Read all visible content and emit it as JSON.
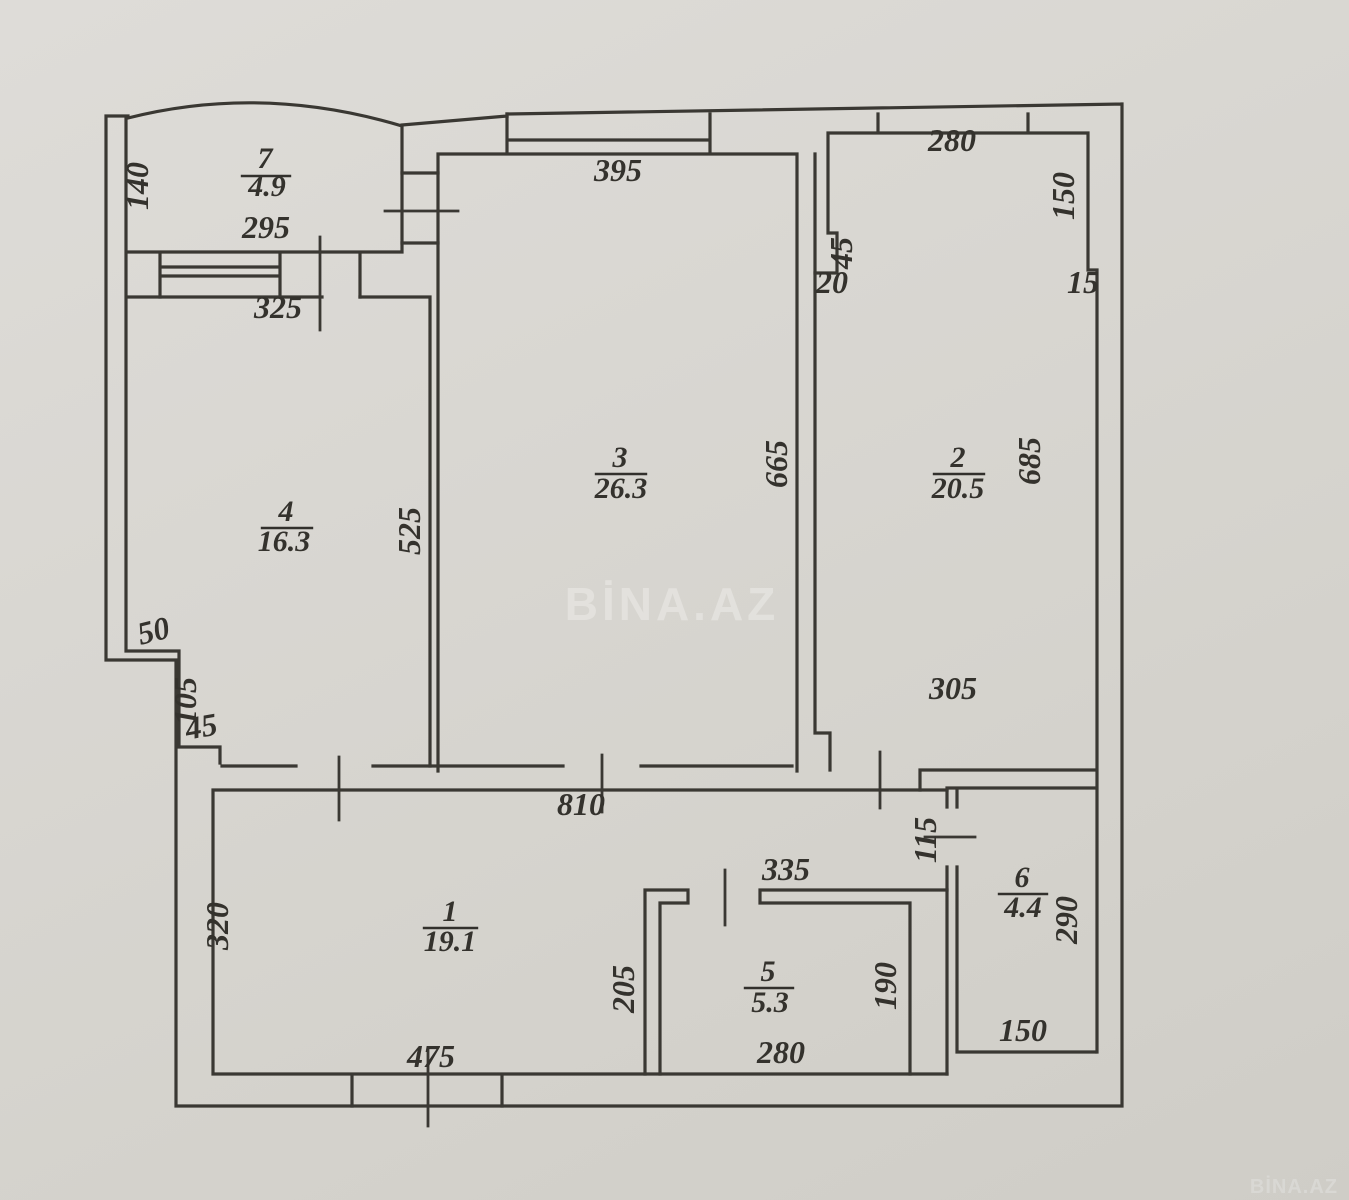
{
  "watermark": {
    "center": "BİNA.AZ",
    "corner": "BİNA.AZ"
  },
  "rooms": [
    {
      "number": "1",
      "area": "19.1"
    },
    {
      "number": "2",
      "area": "20.5"
    },
    {
      "number": "3",
      "area": "26.3"
    },
    {
      "number": "4",
      "area": "16.3"
    },
    {
      "number": "5",
      "area": "5.3"
    },
    {
      "number": "6",
      "area": "4.4"
    },
    {
      "number": "7",
      "area": "4.9"
    }
  ],
  "dimensions": {
    "balcony_side": "140",
    "balcony_width": "295",
    "room4_top_width": "325",
    "room3_window": "395",
    "room2_window": "280",
    "room2_right_upper": "150",
    "room2_niche_height": "45",
    "room2_niche_width": "20",
    "room2_right_step": "15",
    "room3_height": "665",
    "room2_height": "685",
    "room4_height": "525",
    "left_step_width": "50",
    "left_step_height": "105",
    "left_step_inset": "45",
    "room2_width": "305",
    "hall_width": "810",
    "hall_height": "320",
    "hall_bottom": "475",
    "room5_top": "335",
    "room5_left": "205",
    "room5_right": "190",
    "room5_bottom": "280",
    "room6_door": "115",
    "room6_height": "290",
    "room6_bottom": "150"
  }
}
